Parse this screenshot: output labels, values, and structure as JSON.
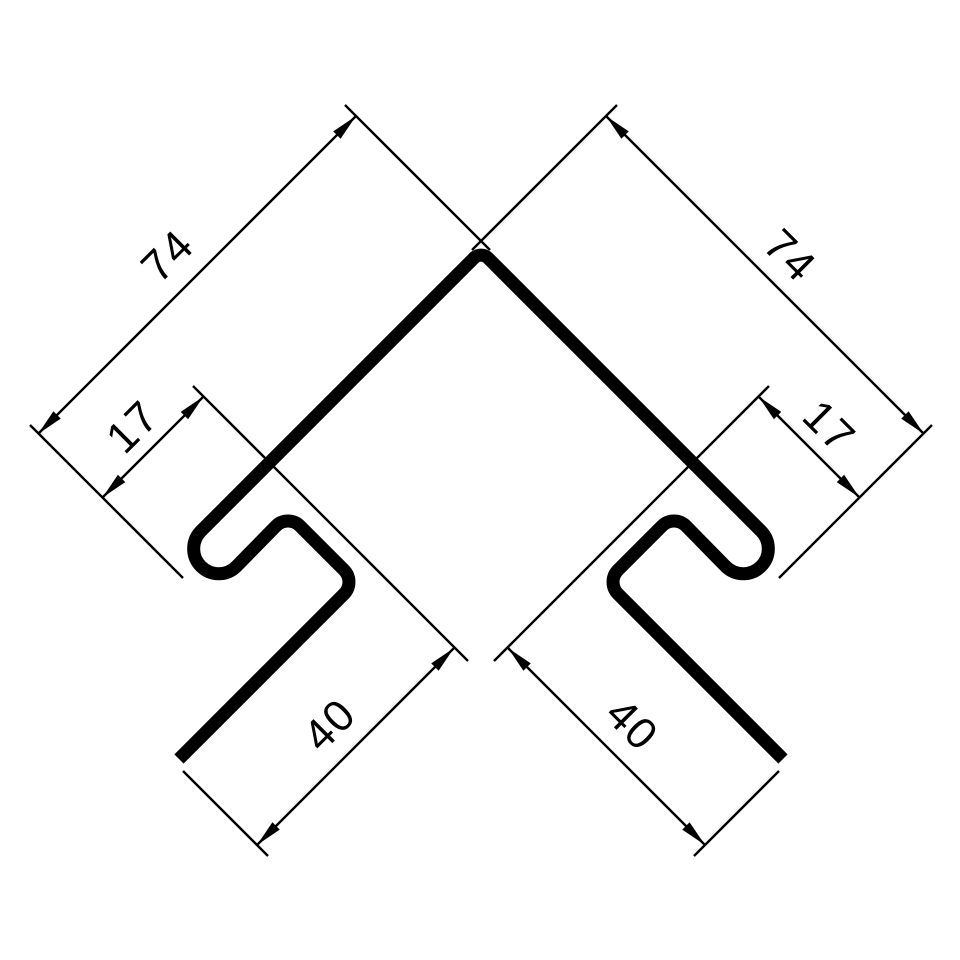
{
  "drawing": {
    "description": "Technical cross-section drawing of a symmetric metal corner trim profile with panel hooks, annotated with linear dimensions",
    "background_color": "#ffffff",
    "ink_color": "#000000",
    "units_shown": false
  },
  "labels": {
    "left_leg": "74",
    "right_leg": "74",
    "left_hook": "17",
    "right_hook": "17",
    "left_flange": "40",
    "right_flange": "40"
  }
}
